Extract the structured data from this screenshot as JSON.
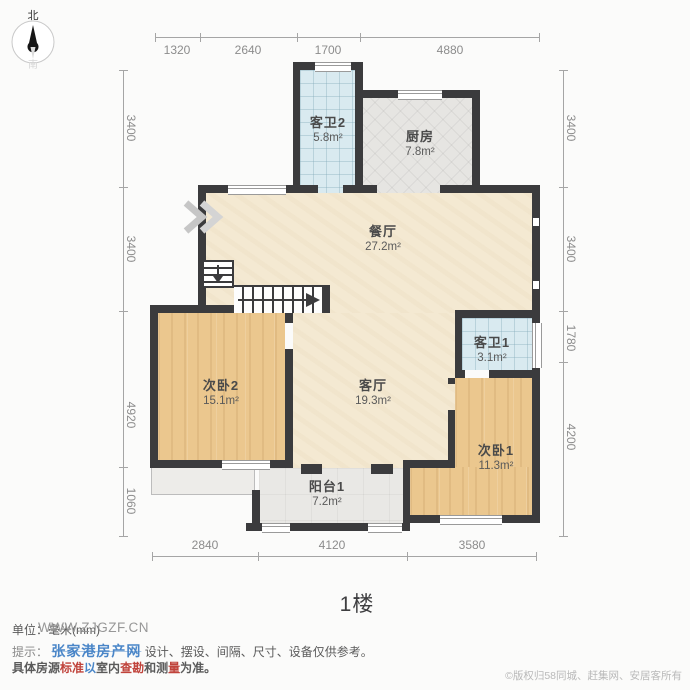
{
  "compass": {
    "north": "北",
    "south": "南"
  },
  "floor_label": "1楼",
  "rooms": [
    {
      "id": "guest_bath_2",
      "name": "客卫2",
      "area": "5.8m²"
    },
    {
      "id": "kitchen",
      "name": "厨房",
      "area": "7.8m²"
    },
    {
      "id": "dining_room",
      "name": "餐厅",
      "area": "27.2m²"
    },
    {
      "id": "guest_bath_1",
      "name": "客卫1",
      "area": "3.1m²"
    },
    {
      "id": "bedroom_2",
      "name": "次卧2",
      "area": "15.1m²"
    },
    {
      "id": "living_room",
      "name": "客厅",
      "area": "19.3m²"
    },
    {
      "id": "bedroom_1",
      "name": "次卧1",
      "area": "11.3m²"
    },
    {
      "id": "balcony_1",
      "name": "阳台1",
      "area": "7.2m²"
    }
  ],
  "dimensions": {
    "top": [
      "1320",
      "2640",
      "1700",
      "4880"
    ],
    "bottom": [
      "2840",
      "4120",
      "3580"
    ],
    "left": [
      "3400",
      "3400",
      "4920",
      "1060"
    ],
    "right": [
      "3400",
      "3400",
      "1780",
      "4200"
    ]
  },
  "footer": {
    "unit_label": "单位：毫米(mm)",
    "watermark_url": "WWW.ZJGZF.CN",
    "tip_prefix": "提示：",
    "watermark_site": "张家港房产网",
    "tip_text": "设计、摆设、间隔、尺寸、设备仅供参考。",
    "line3_segments": [
      {
        "t": "具体房源",
        "c": "dark"
      },
      {
        "t": "标准",
        "c": "red"
      },
      {
        "t": "以",
        "c": "blue"
      },
      {
        "t": "室内",
        "c": "dark"
      },
      {
        "t": "查勘",
        "c": "red"
      },
      {
        "t": "和",
        "c": "dark"
      },
      {
        "t": "测",
        "c": "dark"
      },
      {
        "t": "量",
        "c": "red"
      },
      {
        "t": "为准。",
        "c": "dark"
      }
    ],
    "copyright": "©版权归58同城、赶集网、安居客所有"
  },
  "colors": {
    "wall": "#3b3b3d",
    "wood_floor": "#ebc78e",
    "beige_floor": "#f4e9d2",
    "bath_tile": "#d9eaf0",
    "kitchen_tile": "#e6e5e2",
    "balcony_floor": "#e9e8e5",
    "dimension_text": "#8c8c8c",
    "watermark_blue": "#4a86c8",
    "watermark_red": "#c0433b"
  }
}
